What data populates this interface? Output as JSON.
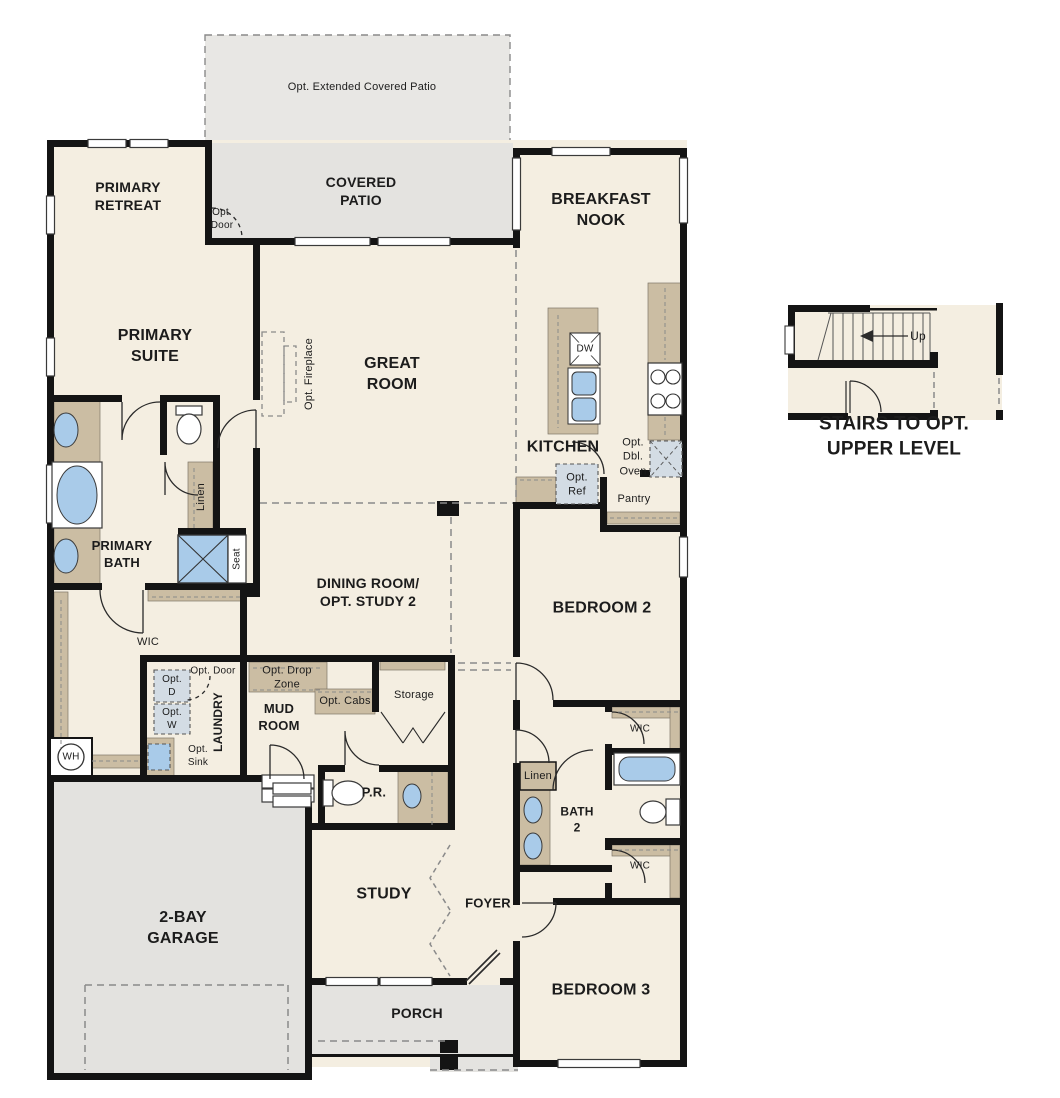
{
  "labels": {
    "opt_extended_patio": "Opt. Extended Covered Patio",
    "primary_retreat": "PRIMARY\nRETREAT",
    "covered_patio": "COVERED\nPATIO",
    "opt_door_patio": "Opt.\nDoor",
    "breakfast_nook": "BREAKFAST\nNOOK",
    "primary_suite": "PRIMARY\nSUITE",
    "great_room": "GREAT\nROOM",
    "opt_fireplace": "Opt. Fireplace",
    "kitchen": "KITCHEN",
    "dw": "DW",
    "opt_ref": "Opt.\nRef",
    "opt_dbl_oven": "Opt.\nDbl.\nOven",
    "pantry": "Pantry",
    "primary_bath": "PRIMARY\nBATH",
    "linen_primary": "Linen",
    "seat": "Seat",
    "wic_primary": "WIC",
    "wh": "WH",
    "laundry": "LAUNDRY",
    "opt_d": "Opt.\nD",
    "opt_w": "Opt.\nW",
    "opt_sink": "Opt.\nSink",
    "opt_door_laundry": "Opt. Door",
    "opt_drop_zone": "Opt. Drop\nZone",
    "mud_room": "MUD\nROOM",
    "opt_cabs": "Opt. Cabs",
    "storage": "Storage",
    "pr": "P.R.",
    "dining_room": "DINING ROOM/\nOPT. STUDY 2",
    "bedroom2": "BEDROOM 2",
    "wic_bed2_a": "WIC",
    "linen_hall": "Linen",
    "bath2": "BATH\n2",
    "wic_bed2_b": "WIC",
    "study": "STUDY",
    "foyer": "FOYER",
    "bedroom3": "BEDROOM 3",
    "porch": "PORCH",
    "garage": "2-BAY\nGARAGE",
    "stairs_up": "Up",
    "stairs_caption": "STAIRS TO OPT. UPPER LEVEL"
  },
  "colors": {
    "floor": "#f4eee1",
    "patio_gray": "#e4e3e0",
    "ext_patio_gray": "#e8e7e4",
    "wall_black": "#141414",
    "cabinet_tan": "#cbbda3",
    "fixture_blue": "#a9cbe9",
    "optional_blue_gray": "#d3dce4",
    "dashed_gray": "#8a8a8a",
    "text": "#1c1c1c"
  }
}
